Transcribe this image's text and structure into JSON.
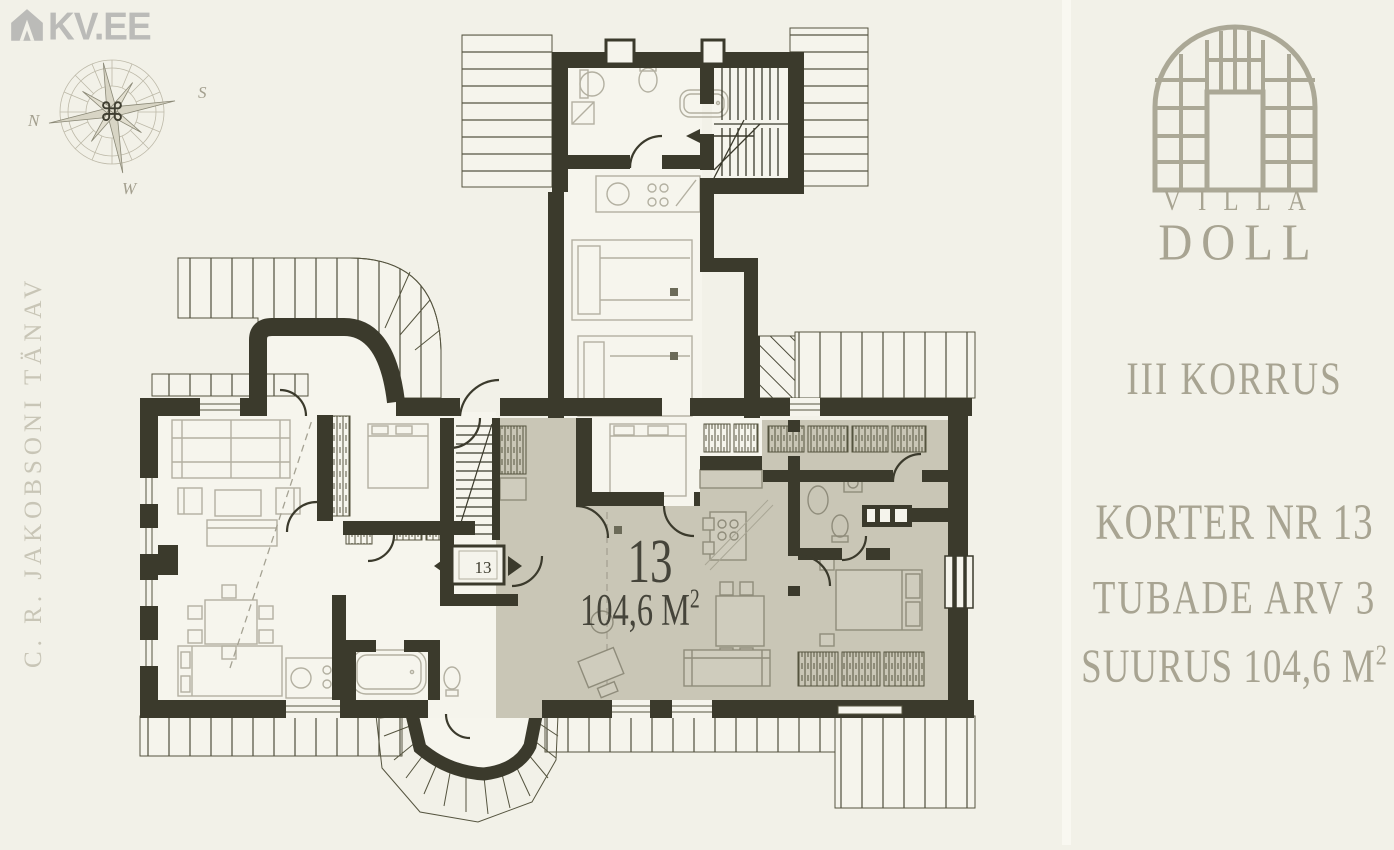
{
  "site": {
    "logo_text": "KV.EE"
  },
  "compass": {
    "n": "N",
    "s": "S",
    "w": "W",
    "center_symbol": "⌘"
  },
  "street": {
    "label": "C. R. JAKOBSONI TÄNAV"
  },
  "plan": {
    "apartment_number": "13",
    "area_value": "104,6 M",
    "area_sup": "2",
    "entry_label": "13"
  },
  "sidebar": {
    "logo_word1": "VILLA",
    "logo_word2": "DOLL",
    "floor_label": "III KORRUS",
    "apartment_label": "KORTER NR 13",
    "rooms_label": "TUBADE ARV 3",
    "size_label": "SUURUS 104,6 M",
    "size_sup": "2"
  },
  "colors": {
    "background": "#f2f1e8",
    "wall": "#3b3a2c",
    "highlight_apartment": "#c9c6b6",
    "brand_sage": "#a8a492",
    "kv_gray": "#bbbbb8"
  }
}
